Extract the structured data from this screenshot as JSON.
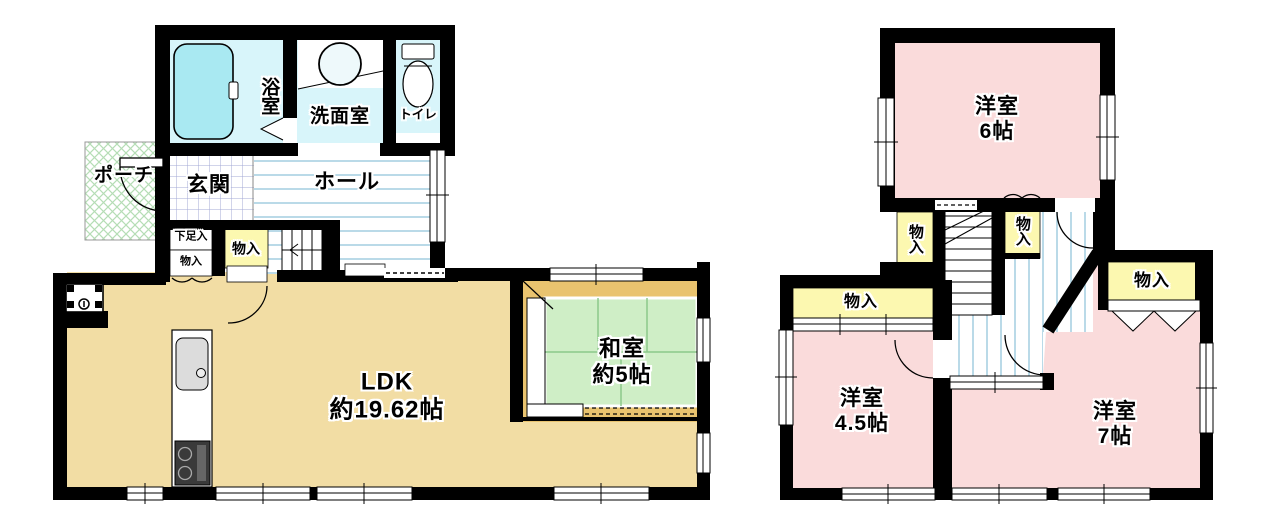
{
  "floor1": {
    "bath": "浴室",
    "washroom": "洗面室",
    "toilet": "トイレ",
    "porch": "ポーチ",
    "entrance": "玄関",
    "hall": "ホール",
    "shoe_storage": "下足入",
    "closet": "物入",
    "ldk_name": "LDK",
    "ldk_size": "約19.62帖",
    "japanese_room_name": "和室",
    "japanese_room_size": "約5帖"
  },
  "floor2": {
    "bedroom6_name": "洋室",
    "bedroom6_size": "6帖",
    "bedroom45_name": "洋室",
    "bedroom45_size": "4.5帖",
    "bedroom7_name": "洋室",
    "bedroom7_size": "7帖",
    "closet": "物入"
  },
  "colors": {
    "wall": "#000000",
    "ldk_floor": "#f2dda4",
    "tatami": "#cfeec6",
    "tatami_line": "#8cc98a",
    "wood_edge": "#e9c36f",
    "bedroom_floor": "#fadbdb",
    "closet_fill": "#fcf8b0",
    "sanitary_fill": "#d8f5fa",
    "bathtub_fill": "#a9e9f2",
    "hall_stripe": "#a3cde0",
    "entrance_grid": "#a3a8d6",
    "porch_hatch": "#b5ddb5"
  }
}
